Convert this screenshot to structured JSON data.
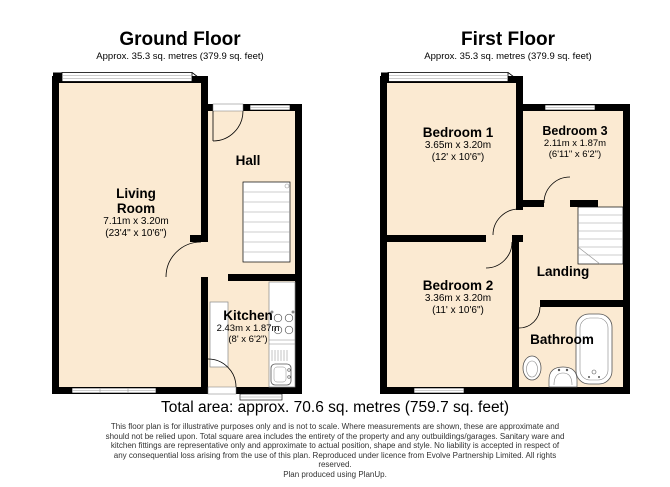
{
  "colors": {
    "floor_fill": "#FBEAD2",
    "wall": "#000000",
    "background": "#FFFFFF",
    "fixture_stroke": "#555555"
  },
  "ground_floor": {
    "title": "Ground Floor",
    "subtitle": "Approx. 35.3 sq. metres (379.9 sq. feet)",
    "rooms": {
      "living_room": {
        "name": "Living Room",
        "dims_metric": "7.11m x 3.20m",
        "dims_imperial": "(23'4\" x 10'6\")"
      },
      "hall": {
        "name": "Hall"
      },
      "kitchen": {
        "name": "Kitchen",
        "dims_metric": "2.43m x 1.87m",
        "dims_imperial": "(8' x 6'2\")"
      }
    }
  },
  "first_floor": {
    "title": "First Floor",
    "subtitle": "Approx. 35.3 sq. metres (379.9 sq. feet)",
    "rooms": {
      "bedroom_1": {
        "name": "Bedroom 1",
        "dims_metric": "3.65m x 3.20m",
        "dims_imperial": "(12' x 10'6\")"
      },
      "bedroom_3": {
        "name": "Bedroom 3",
        "dims_metric": "2.11m x 1.87m",
        "dims_imperial": "(6'11\" x 6'2\")"
      },
      "bedroom_2": {
        "name": "Bedroom 2",
        "dims_metric": "3.36m x 3.20m",
        "dims_imperial": "(11' x 10'6\")"
      },
      "landing": {
        "name": "Landing"
      },
      "bathroom": {
        "name": "Bathroom"
      }
    }
  },
  "footer": {
    "total_area": "Total area: approx. 70.6 sq. metres (759.7 sq. feet)",
    "disclaimer": "This floor plan is for illustrative purposes only and is not to scale.  Where measurements are shown, these are approximate and should not be relied upon. Total square area includes the entirety of the property and any outbuildings/garages. Sanitary ware and kitchen fittings are representative only and approximate to actual position, shape and style.  No liability is accepted in respect of any consequential loss arising from the use of this plan. Reproduced under licence from Evolve Partnership Limited. All rights reserved.",
    "produced_by": "Plan produced using PlanUp."
  }
}
